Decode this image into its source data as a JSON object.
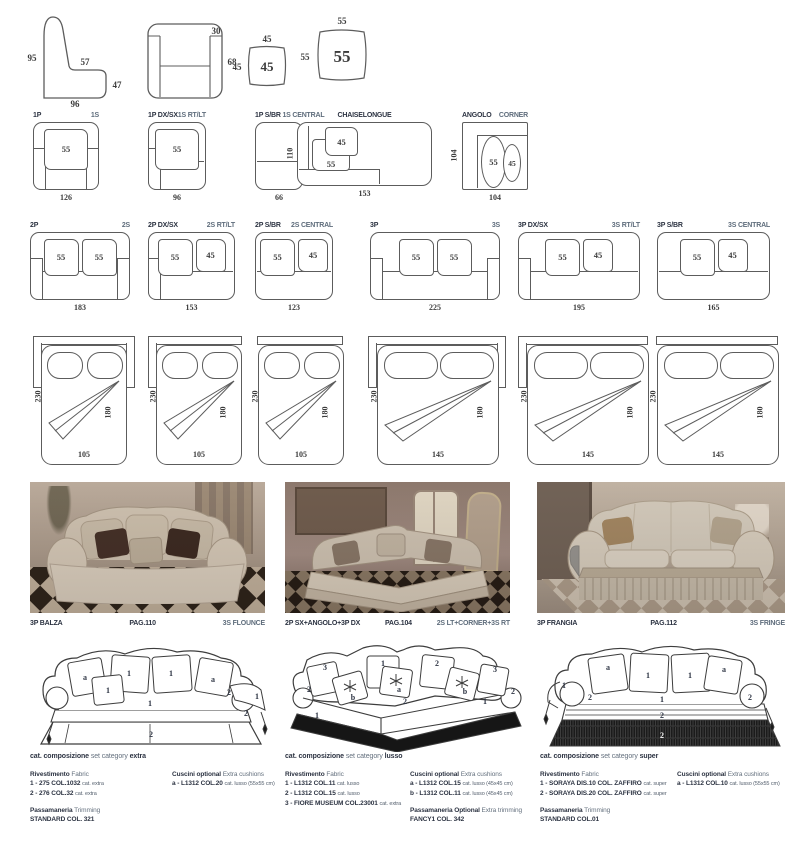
{
  "specs": {
    "side_profile": {
      "left": "95",
      "seat": "57",
      "right": "47",
      "bottom": "96"
    },
    "front_view": {
      "top": "30",
      "right": "68"
    },
    "cushion_small": {
      "top": "45",
      "left": "45",
      "center": "45"
    },
    "cushion_large": {
      "top": "55",
      "left": "55",
      "center": "55"
    }
  },
  "modules_row1": [
    {
      "it": "1P",
      "en": "1S",
      "width": "126",
      "cushions": [
        "55"
      ]
    },
    {
      "it": "1P DX/SX",
      "en": "1S RT/LT",
      "width": "96",
      "cushions": [
        "55"
      ]
    },
    {
      "it": "1P S/BR",
      "en": "1S CENTRAL",
      "width": "66",
      "cushions": []
    },
    {
      "it": "CHAISELONGUE",
      "width": "153",
      "height": "110",
      "cushions": [
        "45",
        "55"
      ]
    },
    {
      "it": "ANGOLO",
      "en": "CORNER",
      "width": "104",
      "height": "104",
      "cushions": [
        "55",
        "45"
      ]
    }
  ],
  "modules_row2": [
    {
      "it": "2P",
      "en": "2S",
      "width": "183",
      "cushions": [
        "55",
        "55"
      ]
    },
    {
      "it": "2P DX/SX",
      "en": "2S RT/LT",
      "width": "153",
      "cushions": [
        "55",
        "45"
      ]
    },
    {
      "it": "2P S/BR",
      "en": "2S CENTRAL",
      "width": "123",
      "cushions": [
        "55",
        "45"
      ]
    },
    {
      "it": "3P",
      "en": "3S",
      "width": "225",
      "cushions": [
        "55",
        "55"
      ]
    },
    {
      "it": "3P DX/SX",
      "en": "3S RT/LT",
      "width": "195",
      "cushions": [
        "55",
        "45"
      ]
    },
    {
      "it": "3P S/BR",
      "en": "3S CENTRAL",
      "width": "165",
      "cushions": [
        "55",
        "45"
      ]
    }
  ],
  "sofa_beds": [
    {
      "depth": "230",
      "mattress": "180",
      "width": "105"
    },
    {
      "depth": "230",
      "mattress": "180",
      "width": "105"
    },
    {
      "depth": "230",
      "mattress": "180",
      "width": "105"
    },
    {
      "depth": "230",
      "mattress": "180",
      "width": "145"
    },
    {
      "depth": "230",
      "mattress": "180",
      "width": "145"
    },
    {
      "depth": "230",
      "mattress": "180",
      "width": "145"
    }
  ],
  "photos": [
    {
      "it": "3P BALZA",
      "page": "PAG.110",
      "en": "3S FLOUNCE"
    },
    {
      "it": "2P SX+ANGOLO+3P DX",
      "page": "PAG.104",
      "en": "2S LT+CORNER+3S RT"
    },
    {
      "it": "3P FRANGIA",
      "page": "PAG.112",
      "en": "3S FRINGE"
    }
  ],
  "sketches": [
    {
      "labels": [
        "a",
        "1",
        "1",
        "a",
        "1",
        "1",
        "2",
        "1",
        "2",
        "2"
      ]
    },
    {
      "labels": [
        "3",
        "1",
        "2",
        "3",
        "b",
        "a",
        "b",
        "2",
        "1",
        "2",
        "2",
        "1"
      ]
    },
    {
      "labels": [
        "a",
        "1",
        "1",
        "a",
        "1",
        "2",
        "1",
        "2",
        "2",
        "2"
      ]
    }
  ],
  "info_blocks": [
    {
      "category_it": "cat. composizione",
      "category_en": "set category",
      "category_value": "extra",
      "fabric_it": "Rivestimento",
      "fabric_en": "Fabric",
      "fabric_lines": [
        {
          "main": "1 - 275 COL.1032",
          "note": "cat. extra"
        },
        {
          "main": "2 - 276 COL.32",
          "note": "cat. extra"
        }
      ],
      "trim_it": "Passamaneria",
      "trim_en": "Trimming",
      "trim_value": "STANDARD COL. 321",
      "cushions_it": "Cuscini optional",
      "cushions_en": "Extra cushions",
      "cushion_lines": [
        {
          "main": "a - L1312 COL.20",
          "note": "cat. lusso (55x55 cm)"
        }
      ]
    },
    {
      "category_it": "cat. composizione",
      "category_en": "set category",
      "category_value": "lusso",
      "fabric_it": "Rivestimento",
      "fabric_en": "Fabric",
      "fabric_lines": [
        {
          "main": "1 - L1312 COL.11",
          "note": "cat. lusso"
        },
        {
          "main": "2 - L1312 COL.15",
          "note": "cat. lusso"
        },
        {
          "main": "3 - FIORE MUSEUM COL.23001",
          "note": "cat. extra"
        }
      ],
      "trim_it": "Passamaneria Optional",
      "trim_en": "Extra trimming",
      "trim_value": "FANCY1 COL. 342",
      "cushions_it": "Cuscini optional",
      "cushions_en": "Extra cushions",
      "cushion_lines": [
        {
          "main": "a - L1312 COL.15",
          "note": "cat. lusso (45x45 cm)"
        },
        {
          "main": "b - L1312 COL.11",
          "note": "cat. lusso (45x45 cm)"
        }
      ]
    },
    {
      "category_it": "cat. composizione",
      "category_en": "set category",
      "category_value": "super",
      "fabric_it": "Rivestimento",
      "fabric_en": "Fabric",
      "fabric_lines": [
        {
          "main": "1 - SORAYA DIS.10 COL. ZAFFIRO",
          "note": "cat. super"
        },
        {
          "main": "2 - SORAYA DIS.20 COL. ZAFFIRO",
          "note": "cat. super"
        }
      ],
      "trim_it": "Passamaneria",
      "trim_en": "Trimming",
      "trim_value": "STANDARD COL.01",
      "cushions_it": "Cuscini optional",
      "cushions_en": "Extra cushions",
      "cushion_lines": [
        {
          "main": "a - L1312 COL.10",
          "note": "cat. lusso (55x55 cm)"
        }
      ]
    }
  ]
}
